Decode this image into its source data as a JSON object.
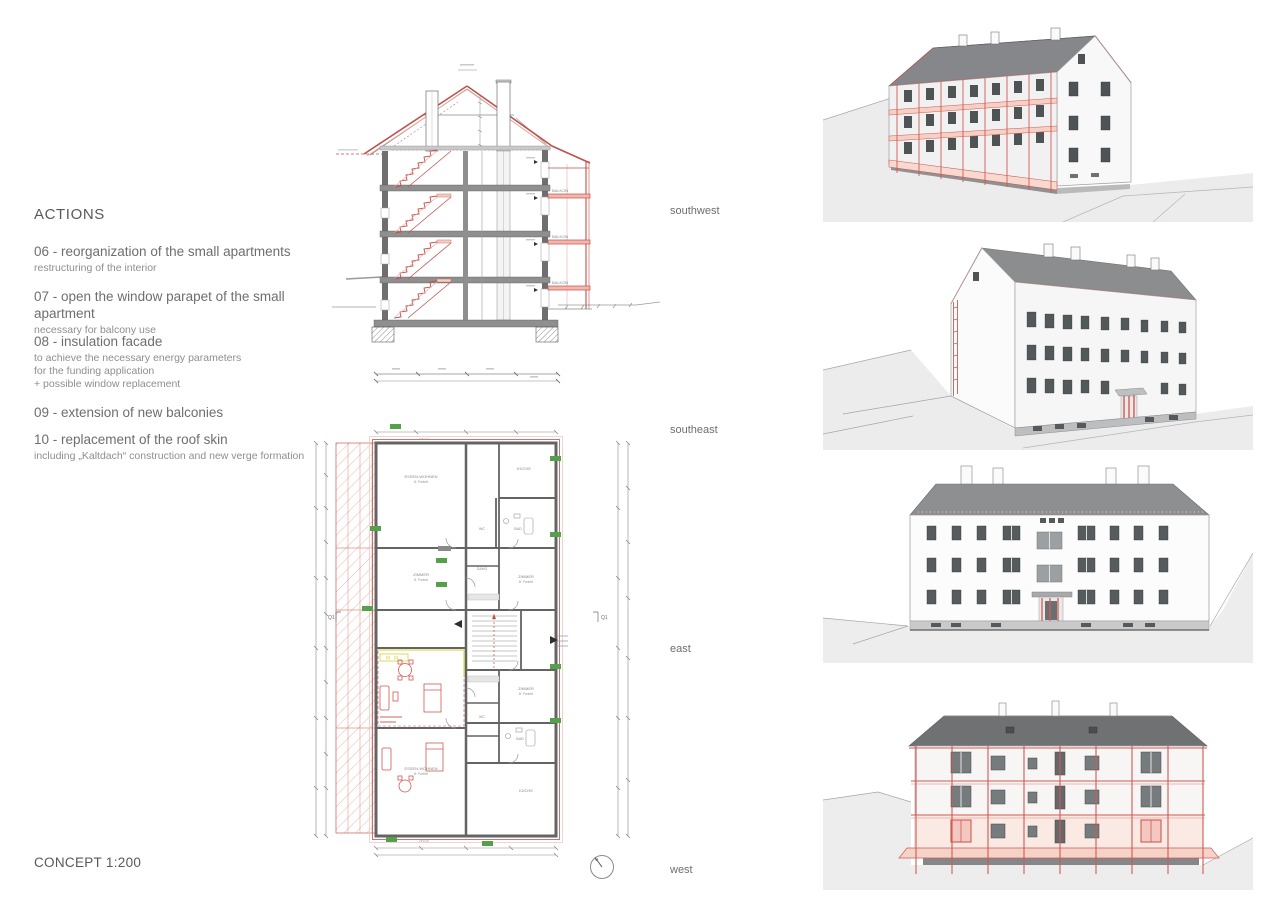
{
  "board": {
    "heading": "ACTIONS",
    "scale_label": "CONCEPT 1:200",
    "actions": [
      {
        "title": "06 - reorganization of the small apartments",
        "note": "restructuring of the interior"
      },
      {
        "title": "07 - open the window parapet of the small apartment",
        "note": "necessary for balcony use"
      },
      {
        "title": "08 - insulation facade",
        "note": "to achieve the necessary energy parameters\nfor the funding application\n+ possible window replacement"
      },
      {
        "title": "09 - extension of new balconies",
        "note": ""
      },
      {
        "title": "10 - replacement of the roof skin",
        "note": "including „Kaltdach“ construction and new verge formation"
      }
    ],
    "view_labels": [
      "southwest",
      "southeast",
      "east",
      "west"
    ]
  },
  "section_drawing": {
    "balcony_labels": [
      "BALKON",
      "BALKON",
      "BALKON"
    ]
  },
  "plan_drawing": {
    "rooms": [
      "ESSEN-WOHNEN",
      "KÜCHE",
      "BAD",
      "WC",
      "GANG",
      "ZIMMER",
      "ZIMMER",
      "ZIMMER",
      "BAD",
      "WC",
      "KÜCHE",
      "ESSEN-WOHNEN"
    ],
    "material_note": "B: Parkett",
    "section_marker": "Q1",
    "wall_tag": "FPH-02"
  },
  "colors": {
    "accent_red": "#c0524c",
    "balcony_fill": "#f6d0c6",
    "tag_green": "#55a04b",
    "roof_gray": "#8a8c8e",
    "roof_dark": "#6f7173",
    "text_gray": "#6d6e71"
  }
}
